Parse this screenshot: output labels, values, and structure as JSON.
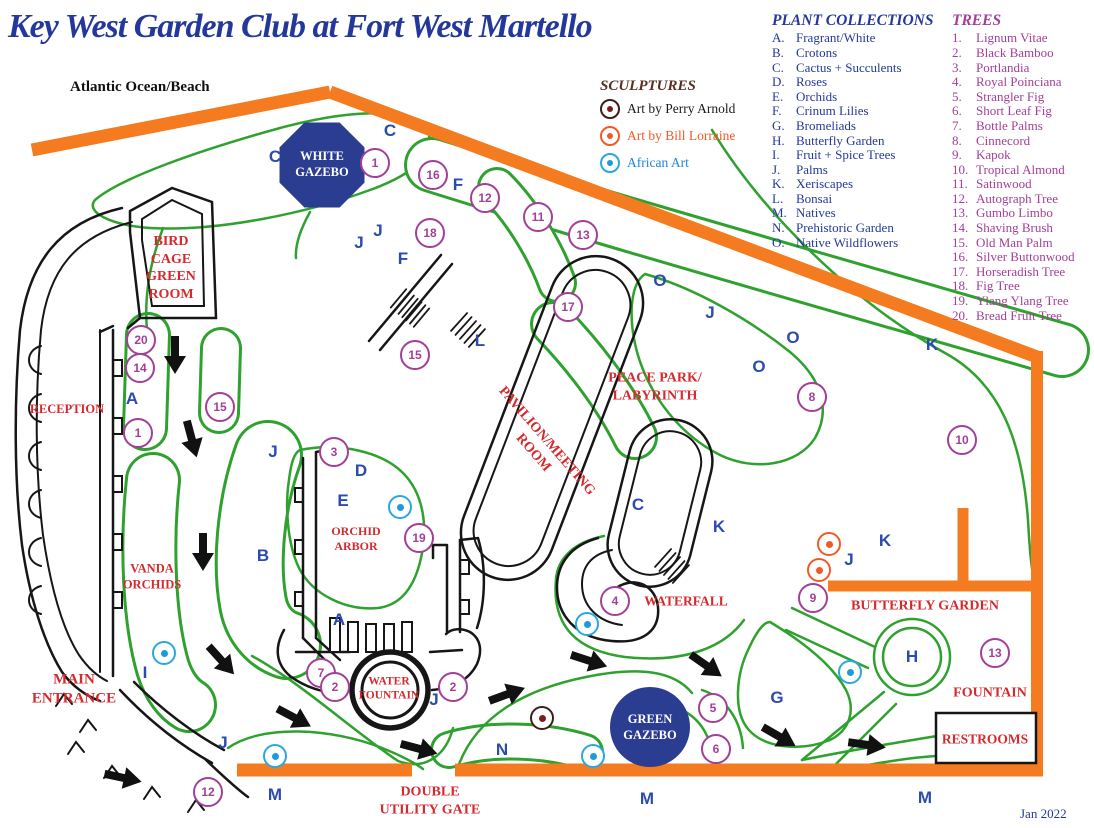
{
  "title": "Key West Garden Club at Fort West Martello",
  "ocean_label": "Atlantic Ocean/Beach",
  "date_label": "Jan 2022",
  "colors": {
    "navy": "#24389b",
    "red": "#d42a2e",
    "blue": "#2b4bae",
    "purple": "#a23f97",
    "green": "#2fa12e",
    "orange": "#f47b20",
    "gazebo_navy": "#2b3d91",
    "perry_ring": "#3a2016",
    "perry_dot": "#7a1f1f",
    "perry_text": "#1a1a1a",
    "bill_ring": "#f05a28",
    "bill_dot": "#f05a28",
    "bill_text": "#f05a28",
    "african_ring": "#29a8e0",
    "african_dot": "#1d9ad8",
    "african_text": "#1d86d8"
  },
  "legend": {
    "sculptures": {
      "title": "SCULPTURES",
      "items": [
        {
          "id": "perry",
          "label": "Art by Perry Arnold"
        },
        {
          "id": "bill",
          "label": "Art by Bill Lorraine"
        },
        {
          "id": "african",
          "label": "African Art"
        }
      ]
    },
    "plant_collections": {
      "title": "PLANT COLLECTIONS",
      "items": [
        {
          "letter": "A.",
          "name": "Fragrant/White"
        },
        {
          "letter": "B.",
          "name": "Crotons"
        },
        {
          "letter": "C.",
          "name": "Cactus + Succulents"
        },
        {
          "letter": "D.",
          "name": "Roses"
        },
        {
          "letter": "E.",
          "name": "Orchids"
        },
        {
          "letter": "F.",
          "name": "Crinum Lilies"
        },
        {
          "letter": "G.",
          "name": "Bromeliads"
        },
        {
          "letter": "H.",
          "name": "Butterfly Garden"
        },
        {
          "letter": "I.",
          "name": "Fruit + Spice Trees"
        },
        {
          "letter": "J.",
          "name": "Palms"
        },
        {
          "letter": "K.",
          "name": "Xeriscapes"
        },
        {
          "letter": "L.",
          "name": "Bonsai"
        },
        {
          "letter": "M.",
          "name": "Natives"
        },
        {
          "letter": "N.",
          "name": "Prehistoric Garden"
        },
        {
          "letter": "O.",
          "name": "Native Wildflowers"
        }
      ]
    },
    "trees": {
      "title": "TREES",
      "items": [
        {
          "num": "1.",
          "name": "Lignum Vitae"
        },
        {
          "num": "2.",
          "name": "Black Bamboo"
        },
        {
          "num": "3.",
          "name": "Portlandia"
        },
        {
          "num": "4.",
          "name": "Royal Poinciana"
        },
        {
          "num": "5.",
          "name": "Strangler Fig"
        },
        {
          "num": "6.",
          "name": "Short Leaf Fig"
        },
        {
          "num": "7.",
          "name": "Bottle Palms"
        },
        {
          "num": "8.",
          "name": "Cinnecord"
        },
        {
          "num": "9.",
          "name": "Kapok"
        },
        {
          "num": "10.",
          "name": "Tropical Almond"
        },
        {
          "num": "11.",
          "name": "Satinwood"
        },
        {
          "num": "12.",
          "name": "Autograph Tree"
        },
        {
          "num": "13.",
          "name": "Gumbo Limbo"
        },
        {
          "num": "14.",
          "name": "Shaving Brush"
        },
        {
          "num": "15.",
          "name": "Old Man Palm"
        },
        {
          "num": "16.",
          "name": "Silver Buttonwood"
        },
        {
          "num": "17.",
          "name": "Horseradish Tree"
        },
        {
          "num": "18.",
          "name": "Fig Tree"
        },
        {
          "num": "19.",
          "name": "Ylang Ylang Tree"
        },
        {
          "num": "20.",
          "name": "Bread Fruit Tree"
        }
      ]
    }
  },
  "map": {
    "place_labels": [
      {
        "id": "bird-cage-green-room",
        "lines": [
          "BIRD",
          "CAGE",
          "GREEN",
          "ROOM"
        ],
        "x": 171,
        "y": 268,
        "size": 14
      },
      {
        "id": "reception",
        "lines": [
          "RECEPTION"
        ],
        "x": 67,
        "y": 410,
        "size": 12.5
      },
      {
        "id": "vanda-orchids",
        "lines": [
          "VANDA",
          "ORCHIDS"
        ],
        "x": 152,
        "y": 577,
        "size": 12.5
      },
      {
        "id": "main-entrance",
        "lines": [
          "MAIN",
          "ENTRANCE"
        ],
        "x": 74,
        "y": 689,
        "size": 15
      },
      {
        "id": "orchid-arbor",
        "lines": [
          "ORCHID",
          "ARBOR"
        ],
        "x": 356,
        "y": 539,
        "size": 12
      },
      {
        "id": "water-fountain",
        "lines": [
          "WATER",
          "FOUNTAIN"
        ],
        "x": 389,
        "y": 689,
        "size": 11.5
      },
      {
        "id": "peace-park-labyrinth",
        "lines": [
          "PEACE PARK/",
          "LABYRINTH"
        ],
        "x": 655,
        "y": 387,
        "size": 14
      },
      {
        "id": "pavilion-meeting-room",
        "lines": [
          "PAVILION/MEETING",
          "ROOM"
        ],
        "x": 540,
        "y": 447,
        "size": 14,
        "rotate": 49
      },
      {
        "id": "waterfall",
        "lines": [
          "WATERFALL"
        ],
        "x": 686,
        "y": 602,
        "size": 13.5
      },
      {
        "id": "butterfly-garden",
        "lines": [
          "BUTTERFLY GARDEN"
        ],
        "x": 925,
        "y": 606,
        "size": 14
      },
      {
        "id": "fountain",
        "lines": [
          "FOUNTAIN"
        ],
        "x": 990,
        "y": 693,
        "size": 14
      },
      {
        "id": "restrooms",
        "lines": [
          "RESTROOMS"
        ],
        "x": 985,
        "y": 740,
        "size": 13.5
      },
      {
        "id": "double-utility-gate",
        "lines": [
          "DOUBLE",
          "UTILITY GATE"
        ],
        "x": 430,
        "y": 801,
        "size": 14
      }
    ],
    "gazebos": [
      {
        "id": "white-gazebo",
        "lines": [
          "WHITE",
          "GAZEBO"
        ],
        "x": 322,
        "y": 164
      },
      {
        "id": "green-gazebo",
        "lines": [
          "GREEN",
          "GAZEBO"
        ],
        "x": 650,
        "y": 727
      }
    ],
    "area_letters": [
      {
        "t": "C",
        "x": 275,
        "y": 157
      },
      {
        "t": "C",
        "x": 390,
        "y": 131
      },
      {
        "t": "J",
        "x": 378,
        "y": 231
      },
      {
        "t": "J",
        "x": 359,
        "y": 243
      },
      {
        "t": "F",
        "x": 458,
        "y": 185
      },
      {
        "t": "F",
        "x": 403,
        "y": 259
      },
      {
        "t": "J",
        "x": 273,
        "y": 452
      },
      {
        "t": "D",
        "x": 361,
        "y": 471
      },
      {
        "t": "E",
        "x": 343,
        "y": 501
      },
      {
        "t": "B",
        "x": 263,
        "y": 556
      },
      {
        "t": "A",
        "x": 132,
        "y": 399
      },
      {
        "t": "A",
        "x": 339,
        "y": 620
      },
      {
        "t": "L",
        "x": 480,
        "y": 341
      },
      {
        "t": "C",
        "x": 638,
        "y": 505
      },
      {
        "t": "K",
        "x": 719,
        "y": 527
      },
      {
        "t": "K",
        "x": 932,
        "y": 345
      },
      {
        "t": "K",
        "x": 885,
        "y": 541
      },
      {
        "t": "J",
        "x": 849,
        "y": 560
      },
      {
        "t": "O",
        "x": 660,
        "y": 281
      },
      {
        "t": "J",
        "x": 710,
        "y": 313
      },
      {
        "t": "O",
        "x": 793,
        "y": 338
      },
      {
        "t": "O",
        "x": 759,
        "y": 367
      },
      {
        "t": "I",
        "x": 145,
        "y": 673
      },
      {
        "t": "J",
        "x": 223,
        "y": 743
      },
      {
        "t": "J",
        "x": 434,
        "y": 700
      },
      {
        "t": "N",
        "x": 502,
        "y": 750
      },
      {
        "t": "G",
        "x": 777,
        "y": 698
      },
      {
        "t": "H",
        "x": 912,
        "y": 657
      },
      {
        "t": "M",
        "x": 275,
        "y": 795
      },
      {
        "t": "M",
        "x": 647,
        "y": 799
      },
      {
        "t": "M",
        "x": 925,
        "y": 798
      }
    ],
    "tree_markers": [
      {
        "n": "20",
        "x": 141,
        "y": 340
      },
      {
        "n": "14",
        "x": 140,
        "y": 368
      },
      {
        "n": "1",
        "x": 138,
        "y": 433
      },
      {
        "n": "15",
        "x": 220,
        "y": 407
      },
      {
        "n": "1",
        "x": 375,
        "y": 163
      },
      {
        "n": "16",
        "x": 433,
        "y": 175
      },
      {
        "n": "12",
        "x": 485,
        "y": 198
      },
      {
        "n": "11",
        "x": 538,
        "y": 217
      },
      {
        "n": "13",
        "x": 583,
        "y": 235
      },
      {
        "n": "18",
        "x": 430,
        "y": 233
      },
      {
        "n": "17",
        "x": 568,
        "y": 307
      },
      {
        "n": "15",
        "x": 415,
        "y": 355
      },
      {
        "n": "3",
        "x": 334,
        "y": 452
      },
      {
        "n": "19",
        "x": 419,
        "y": 538
      },
      {
        "n": "7",
        "x": 321,
        "y": 673
      },
      {
        "n": "2",
        "x": 335,
        "y": 687
      },
      {
        "n": "2",
        "x": 453,
        "y": 687
      },
      {
        "n": "8",
        "x": 812,
        "y": 397
      },
      {
        "n": "10",
        "x": 962,
        "y": 440
      },
      {
        "n": "4",
        "x": 615,
        "y": 601
      },
      {
        "n": "9",
        "x": 813,
        "y": 598
      },
      {
        "n": "5",
        "x": 713,
        "y": 708
      },
      {
        "n": "6",
        "x": 716,
        "y": 749
      },
      {
        "n": "13",
        "x": 995,
        "y": 653
      },
      {
        "n": "12",
        "x": 208,
        "y": 792
      }
    ],
    "sculpture_markers": [
      {
        "type": "african",
        "x": 164,
        "y": 653
      },
      {
        "type": "african",
        "x": 400,
        "y": 507
      },
      {
        "type": "african",
        "x": 587,
        "y": 624
      },
      {
        "type": "african",
        "x": 850,
        "y": 672
      },
      {
        "type": "african",
        "x": 275,
        "y": 756
      },
      {
        "type": "african",
        "x": 593,
        "y": 756
      },
      {
        "type": "bill",
        "x": 829,
        "y": 544
      },
      {
        "type": "bill",
        "x": 819,
        "y": 570
      },
      {
        "type": "perry",
        "x": 542,
        "y": 718
      }
    ],
    "arrows": [
      {
        "x": 175,
        "y": 356,
        "a": 90
      },
      {
        "x": 192,
        "y": 440,
        "a": 75
      },
      {
        "x": 203,
        "y": 553,
        "a": 90
      },
      {
        "x": 222,
        "y": 661,
        "a": 48
      },
      {
        "x": 295,
        "y": 718,
        "a": 28
      },
      {
        "x": 420,
        "y": 749,
        "a": 15
      },
      {
        "x": 508,
        "y": 694,
        "a": -20
      },
      {
        "x": 590,
        "y": 661,
        "a": 18
      },
      {
        "x": 707,
        "y": 666,
        "a": 35
      },
      {
        "x": 780,
        "y": 737,
        "a": 30
      },
      {
        "x": 868,
        "y": 745,
        "a": 8
      },
      {
        "x": 124,
        "y": 778,
        "a": 12
      }
    ]
  }
}
